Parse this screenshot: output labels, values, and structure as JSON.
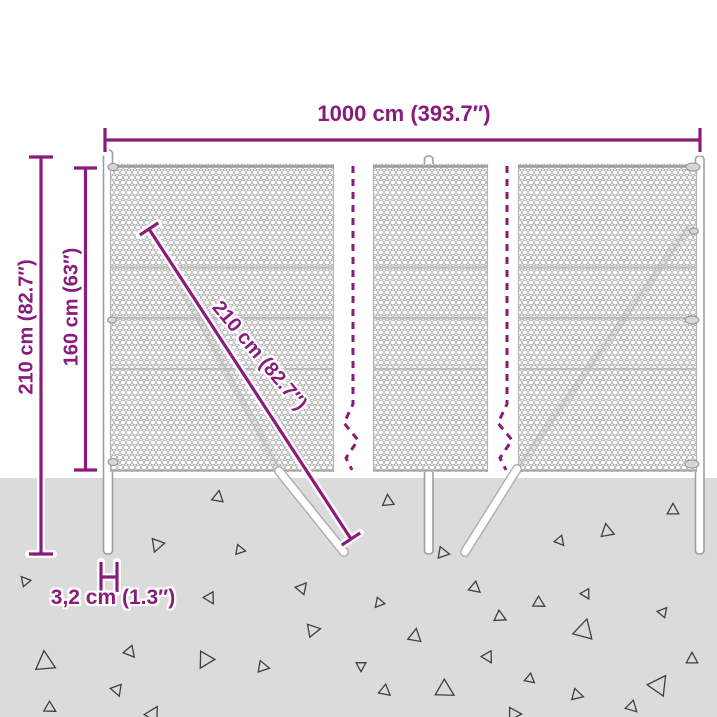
{
  "colors": {
    "dimension": "#8A1A7B",
    "ground": "#DBDBDB",
    "mesh_wire": "#A6A6A6",
    "post_outline": "#9E9E9E",
    "triangle": "#3F3F3F"
  },
  "dimensions": {
    "total_width": {
      "label": "1000 cm (393.7″)"
    },
    "total_height": {
      "label": "210 cm (82.7″)"
    },
    "fence_height": {
      "label": "160 cm (63″)"
    },
    "strut_length": {
      "label": "210 cm (82.7″)"
    },
    "post_width": {
      "label": "3,2 cm (1.3″)"
    }
  },
  "ground": {
    "triangles": [
      [
        218,
        497,
        7,
        10
      ],
      [
        157,
        545,
        8,
        200
      ],
      [
        25,
        581,
        6,
        320
      ],
      [
        210,
        598,
        7,
        150
      ],
      [
        302,
        588,
        7,
        40
      ],
      [
        313,
        630,
        8,
        80
      ],
      [
        45,
        662,
        12,
        355
      ],
      [
        130,
        652,
        7,
        140
      ],
      [
        205,
        660,
        10,
        210
      ],
      [
        263,
        667,
        7,
        100
      ],
      [
        117,
        690,
        7,
        160
      ],
      [
        50,
        708,
        7,
        120
      ],
      [
        153,
        714,
        9,
        30
      ],
      [
        388,
        501,
        7,
        355
      ],
      [
        673,
        510,
        7,
        0
      ],
      [
        607,
        531,
        8,
        350
      ],
      [
        560,
        541,
        6,
        140
      ],
      [
        443,
        553,
        7,
        100
      ],
      [
        475,
        588,
        7,
        130
      ],
      [
        586,
        594,
        6,
        150
      ],
      [
        539,
        603,
        7,
        120
      ],
      [
        663,
        612,
        6,
        40
      ],
      [
        379,
        603,
        6,
        220
      ],
      [
        500,
        617,
        7,
        115
      ],
      [
        415,
        636,
        8,
        10
      ],
      [
        584,
        630,
        12,
        15
      ],
      [
        692,
        659,
        7,
        0
      ],
      [
        488,
        657,
        7,
        150
      ],
      [
        361,
        666,
        6,
        180
      ],
      [
        530,
        679,
        6,
        130
      ],
      [
        445,
        690,
        11,
        120
      ],
      [
        577,
        695,
        7,
        105
      ],
      [
        659,
        685,
        12,
        35
      ],
      [
        632,
        707,
        7,
        135
      ],
      [
        514,
        714,
        8,
        90
      ],
      [
        385,
        691,
        7,
        130
      ],
      [
        240,
        550,
        6,
        100
      ]
    ]
  }
}
